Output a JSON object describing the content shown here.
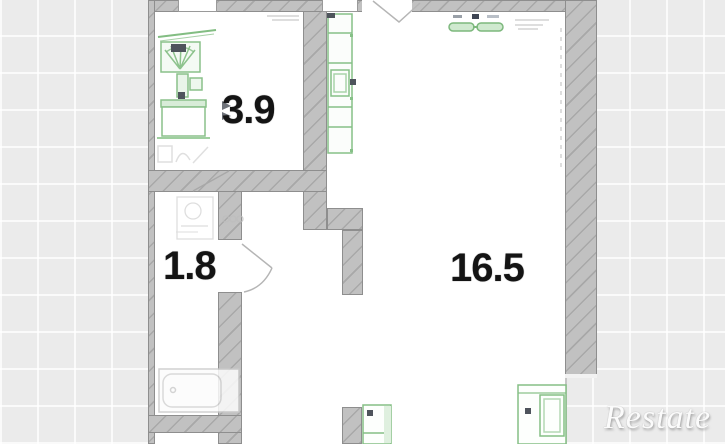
{
  "floorplan": {
    "watermark": "Restate",
    "rooms": [
      {
        "name": "bathroom",
        "area_label": "3.9"
      },
      {
        "name": "hallway",
        "area_label": "1.8"
      },
      {
        "name": "living-room",
        "area_label": "16.5"
      }
    ],
    "fixtures": [
      "toilet",
      "bathroom-sink",
      "washing-machine",
      "sink-sketch",
      "bathtub",
      "kitchen-counter",
      "dining-table",
      "wardrobe",
      "stove",
      "entry-door-swing",
      "interior-door-arc",
      "bathroom-door-line"
    ],
    "colors": {
      "background": "#ebebeb",
      "grid_line": "#ffffff",
      "wall_fill": "#c1c1c1",
      "wall_edge": "#8e8e8e",
      "room_fill": "#ffffff",
      "fixture_stroke": "#82bd82",
      "fixture_dark": "#4e545c",
      "label_text": "#141414",
      "watermark_text": "#fbfbfb"
    }
  }
}
